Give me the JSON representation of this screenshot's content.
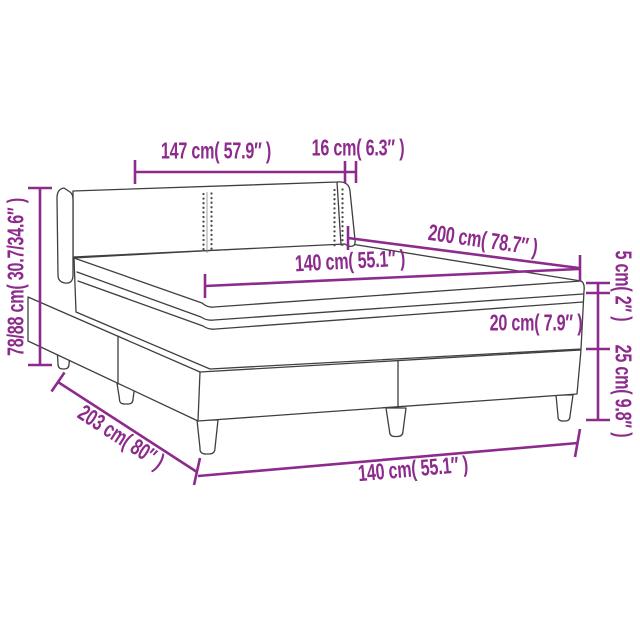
{
  "figure": {
    "title": "Box spring bed dimension diagram",
    "accent_color": "#8D2B8D",
    "line_color": "#3F3F3F",
    "background_color": "#FFFFFF",
    "labels": {
      "headboard_width": "147 cm( 57.9″ )",
      "wing_depth": "16 cm( 6.3″ )",
      "headboard_height": "78/88 cm( 30.7/34.6″ )",
      "bed_length": "200 cm( 78.7″ )",
      "mattress_width": "140 cm( 55.1″ )",
      "topper_height": "5 cm( 2″ )",
      "mattress_height": "20 cm( 7.9″ )",
      "base_height": "25 cm( 9.8″ )",
      "total_length": "203 cm( 80″ )",
      "base_width": "140 cm( 55.1″ )"
    }
  }
}
